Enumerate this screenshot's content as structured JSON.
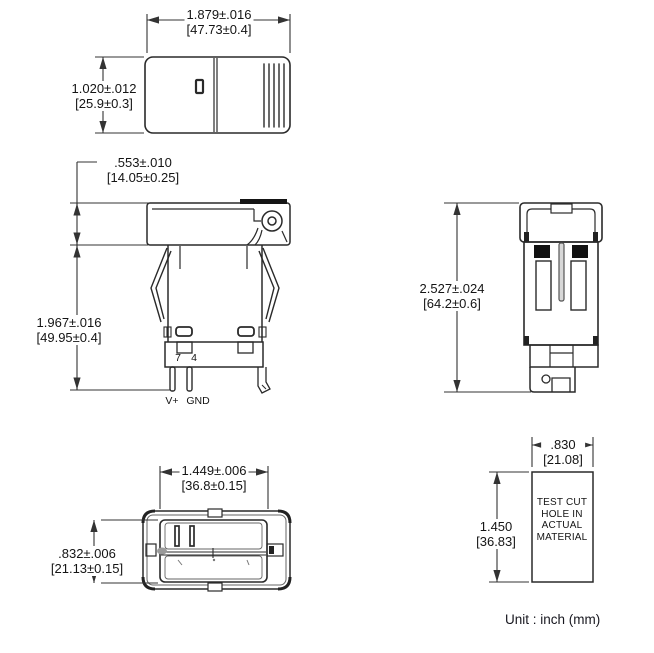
{
  "unit_note": "Unit : inch (mm)",
  "dims": {
    "top_width": {
      "inch": "1.879±.016",
      "mm": "[47.73±0.4]"
    },
    "top_height": {
      "inch": "1.020±.012",
      "mm": "[25.9±0.3]"
    },
    "bezel_height": {
      "inch": ".553±.010",
      "mm": "[14.05±0.25]"
    },
    "body_height": {
      "inch": "1.967±.016",
      "mm": "[49.95±0.4]"
    },
    "overall_height": {
      "inch": "2.527±.024",
      "mm": "[64.2±0.6]"
    },
    "cutout_width": {
      "inch": "1.449±.006",
      "mm": "[36.8±0.15]"
    },
    "cutout_height": {
      "inch": ".832±.006",
      "mm": "[21.13±0.15]"
    },
    "hole_width": {
      "inch": ".830",
      "mm": "[21.08]"
    },
    "hole_height": {
      "inch": "1.450",
      "mm": "[36.83]"
    }
  },
  "pins": {
    "pin7": "7",
    "pin4": "4",
    "vplus": "V+",
    "gnd": "GND"
  },
  "test_hole_note": {
    "line1": "TEST CUT",
    "line2": "HOLE  IN",
    "line3": "ACTUAL",
    "line4": "MATERIAL"
  },
  "colors": {
    "line": "#2a2a2a",
    "dim_line": "#333333",
    "text": "#141414",
    "background": "#ffffff"
  }
}
